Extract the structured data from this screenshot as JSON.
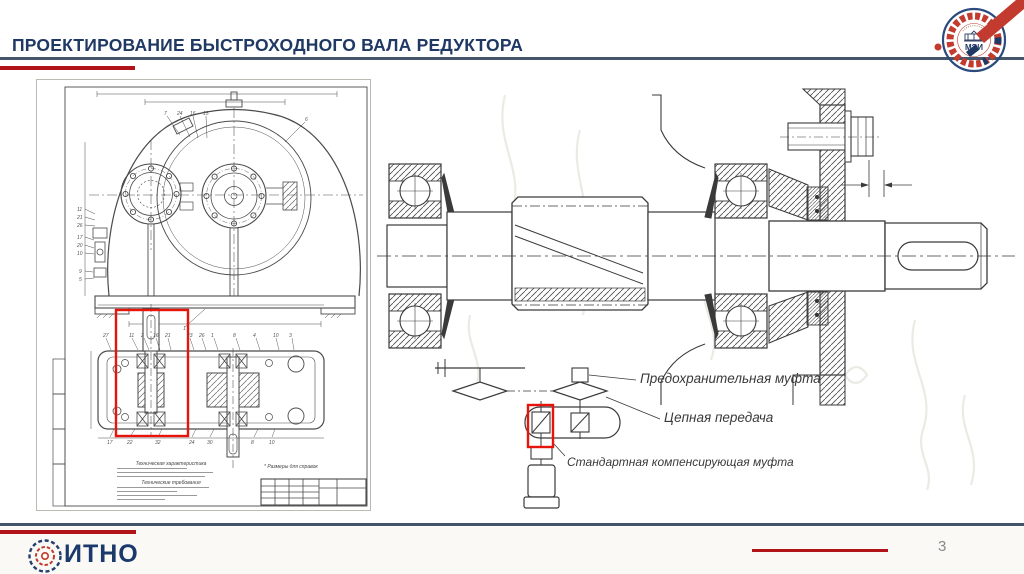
{
  "slide": {
    "title": "ПРОЕКТИРОВАНИЕ БЫСТРОХОДНОГО ВАЛА РЕДУКТОРА",
    "page_number": "3"
  },
  "footer": {
    "logo_text": "ИТНО"
  },
  "header_logo": {
    "text": "МЭИ"
  },
  "colors": {
    "accent_navy": "#1F3864",
    "rule_blue": "#44546A",
    "rule_red": "#B01418",
    "highlight_red": "#E8140C",
    "drawing_ink": "#3a3a3a"
  },
  "right_drawing": {
    "labels": {
      "safety_coupling": "Предохранительная муфта",
      "chain_drive": "Цепная передача",
      "compensating_coupling": "Стандартная компенсирующая муфта"
    }
  },
  "left_drawing": {
    "notes": {
      "tech_spec_title": "Техническая характеристика",
      "tech_req_title": "Технические требования",
      "reference_note": "* Размеры для справок"
    },
    "callouts": {
      "front_top": [
        "7",
        "24",
        "16",
        "15",
        "6"
      ],
      "front_left": [
        "11",
        "21",
        "26",
        "17",
        "20",
        "10",
        "9",
        "5",
        "1"
      ],
      "plan_top": [
        "27",
        "11",
        "2",
        "16",
        "21",
        "23",
        "26",
        "1",
        "8",
        "4",
        "10",
        "3"
      ],
      "plan_bottom": [
        "17",
        "22",
        "32",
        "24",
        "30",
        "8",
        "10"
      ]
    }
  }
}
